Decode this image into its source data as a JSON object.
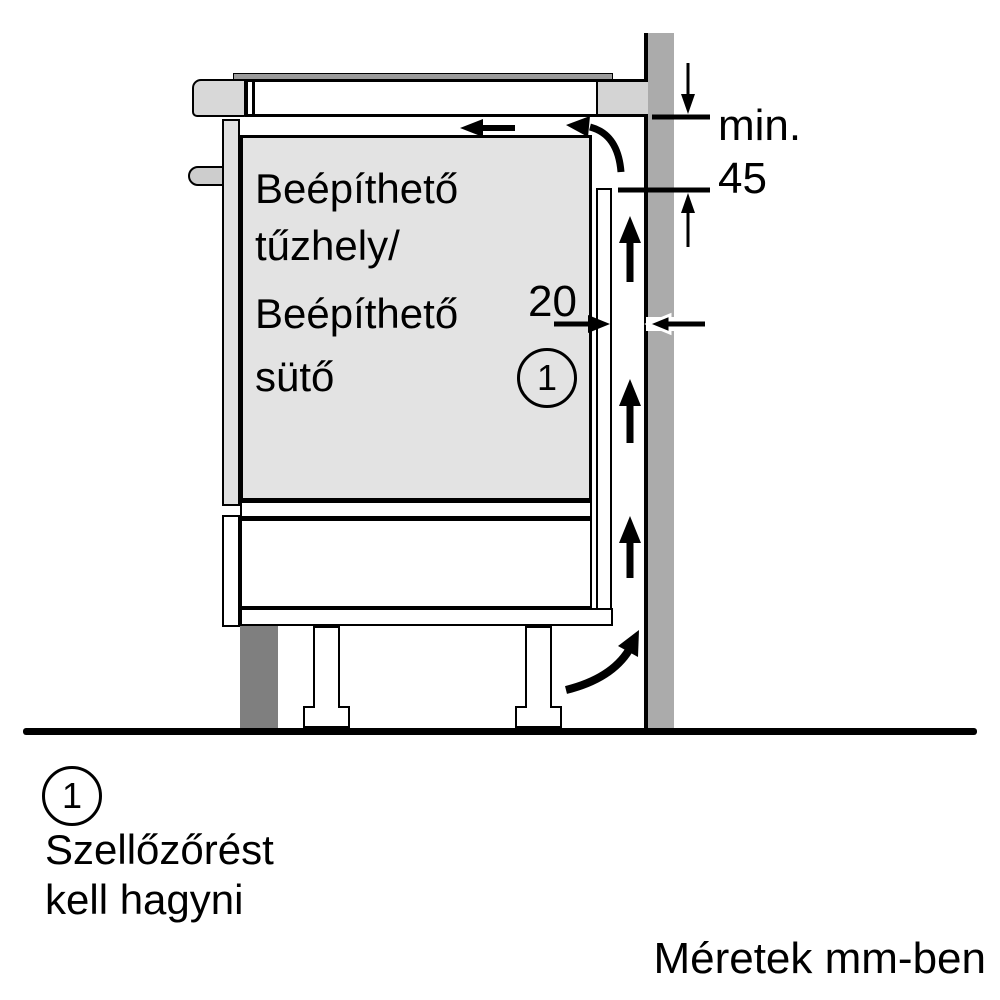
{
  "appliance": {
    "label_lines": [
      "Beépíthető",
      "tűzhely/",
      "Beépíthető",
      "sütő"
    ]
  },
  "dimensions": {
    "min_label": "min.",
    "min_value": "45",
    "gap_value": "20"
  },
  "callout": {
    "number": "1"
  },
  "legend": {
    "number": "1",
    "lines": [
      "Szellőzőrést",
      "kell hagyni"
    ]
  },
  "footer": {
    "units_note": "Méretek mm-ben"
  },
  "colors": {
    "wall": "#ababab",
    "plinth": "#7f7f7f",
    "appliance_fill": "#e3e3e3",
    "trim": "#d8d8d8",
    "outline": "#000000"
  }
}
